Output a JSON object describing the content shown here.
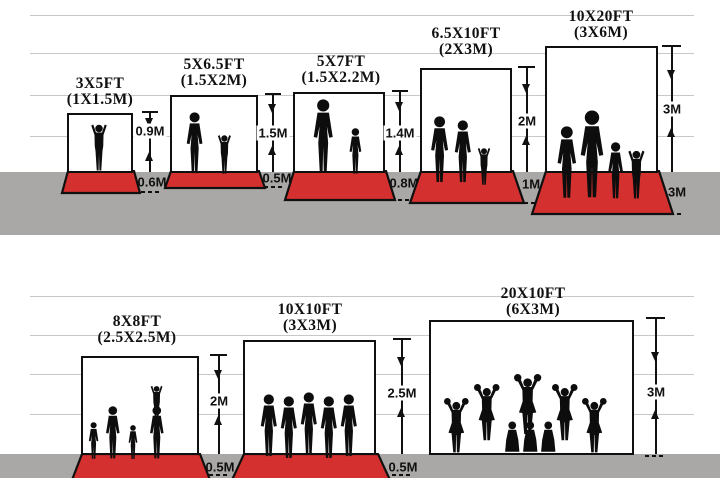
{
  "diagram": "backdrop-size-comparison",
  "colors": {
    "carpet_red": "#d4302f",
    "ground_gray": "#a9a8a6",
    "grid_line": "#c8c8c8",
    "ink": "#101010"
  },
  "rows": [
    {
      "panels": [
        {
          "size_ft": "3X5FT",
          "size_m": "(1X1.5M)",
          "wall_height": "0.9M",
          "floor_depth": "0.6M"
        },
        {
          "size_ft": "5X6.5FT",
          "size_m": "(1.5X2M)",
          "wall_height": "1.5M",
          "floor_depth": "0.5M"
        },
        {
          "size_ft": "5X7FT",
          "size_m": "(1.5X2.2M)",
          "wall_height": "1.4M",
          "floor_depth": "0.8M"
        },
        {
          "size_ft": "6.5X10FT",
          "size_m": "(2X3M)",
          "wall_height": "2M",
          "floor_depth": "1M"
        },
        {
          "size_ft": "10X20FT",
          "size_m": "(3X6M)",
          "wall_height": "3M",
          "floor_depth": "3M"
        }
      ]
    },
    {
      "panels": [
        {
          "size_ft": "8X8FT",
          "size_m": "(2.5X2.5M)",
          "wall_height": "2M",
          "floor_depth": "0.5M"
        },
        {
          "size_ft": "10X10FT",
          "size_m": "(3X3M)",
          "wall_height": "2.5M",
          "floor_depth": "0.5M"
        },
        {
          "size_ft": "20X10FT",
          "size_m": "(6X3M)",
          "wall_height": "3M"
        }
      ]
    }
  ]
}
